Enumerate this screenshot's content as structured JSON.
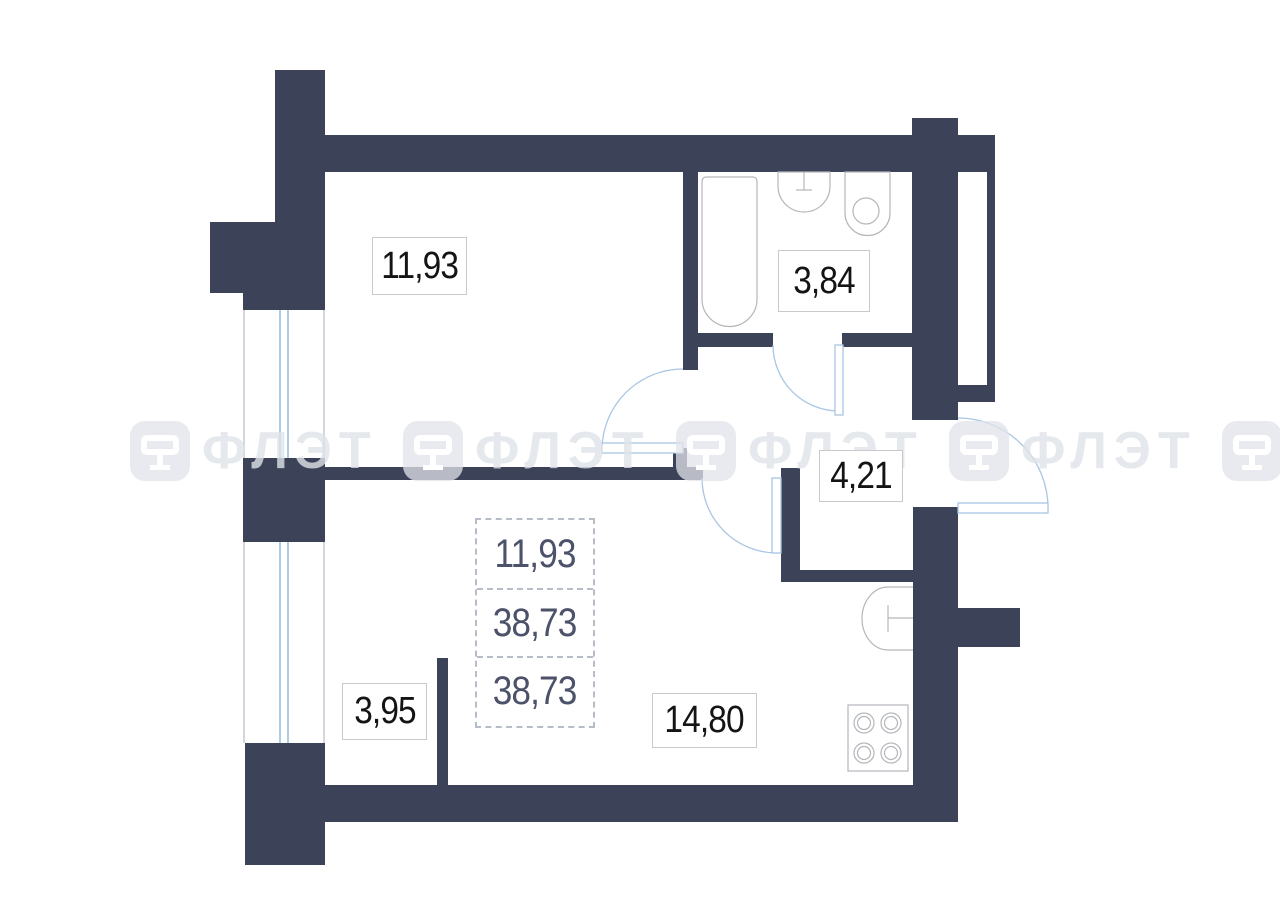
{
  "title": "Apartment floor plan",
  "watermark": {
    "text": "ФЛЭТ",
    "icon": "flet-logo-icon"
  },
  "rooms": {
    "bedroom": {
      "area": "11,93"
    },
    "bathroom": {
      "area": "3,84"
    },
    "hall": {
      "area": "4,21"
    },
    "wardrobe": {
      "area": "3,95"
    },
    "kitchen_living": {
      "area": "14,80"
    }
  },
  "area_summary": {
    "values": [
      "11,93",
      "38,73",
      "38,73"
    ]
  },
  "colors": {
    "wall": "#3c4257",
    "door_arc": "#a9c6e3",
    "window_glass": "#8fbcdb",
    "fixture_outline": "#b3b6ba",
    "summary_text": "#4b5269"
  }
}
